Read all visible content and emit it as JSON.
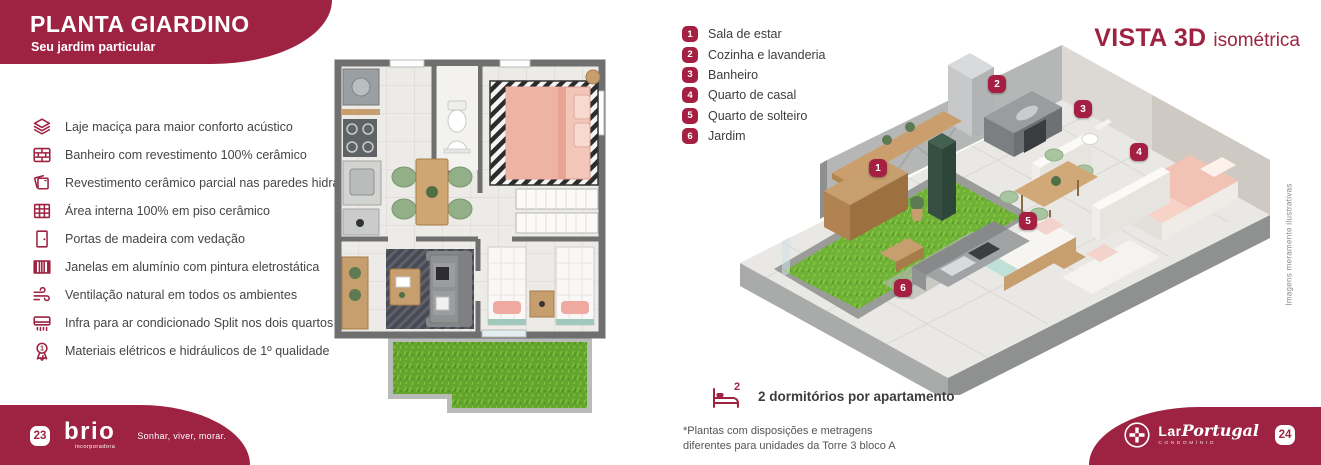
{
  "header": {
    "title": "PLANTA GIARDINO",
    "subtitle": "Seu jardim particular"
  },
  "features": [
    {
      "icon": "slab-layers-icon",
      "label": "Laje maciça para maior conforto acústico"
    },
    {
      "icon": "brick-wall-icon",
      "label": "Banheiro com revestimento 100% cerâmico"
    },
    {
      "icon": "ceramic-tiles-icon",
      "label": "Revestimento cerâmico parcial nas paredes hidráulicas"
    },
    {
      "icon": "floor-grid-icon",
      "label": "Área interna 100% em piso cerâmico"
    },
    {
      "icon": "door-icon",
      "label": "Portas de madeira com vedação"
    },
    {
      "icon": "window-icon",
      "label": "Janelas em alumínio com pintura eletrostática"
    },
    {
      "icon": "wind-icon",
      "label": "Ventilação natural em todos os ambientes"
    },
    {
      "icon": "air-conditioner-icon",
      "label": "Infra para ar condicionado Split nos dois quartos"
    },
    {
      "icon": "first-quality-medal-icon",
      "label": "Materiais elétricos e hidráulicos de 1º qualidade"
    }
  ],
  "legend": [
    {
      "number": "1",
      "label": "Sala de estar"
    },
    {
      "number": "2",
      "label": "Cozinha e lavanderia"
    },
    {
      "number": "3",
      "label": "Banheiro"
    },
    {
      "number": "4",
      "label": "Quarto de casal"
    },
    {
      "number": "5",
      "label": "Quarto de solteiro"
    },
    {
      "number": "6",
      "label": "Jardim"
    }
  ],
  "vista": {
    "title": "VISTA 3D",
    "subtitle": "isométrica"
  },
  "notes": {
    "vertical": "Imagens meramente ilustrativas",
    "dorm_count": "2",
    "dorm_label": "2 dormitórios por apartamento",
    "footnote_line1": "*Plantas com disposições e metragens",
    "footnote_line2": "diferentes para unidades da Torre 3 bloco A",
    "medal_number": "1"
  },
  "footer": {
    "left_page": "23",
    "brand": "brio",
    "brand_sub": "incorporadora",
    "tagline": "Sonhar, viver, morar.",
    "right_brand_lar": "Lar",
    "right_brand_portugal": "Portugal",
    "right_brand_sub": "CONDOMÍNIO",
    "right_page": "24"
  },
  "colors": {
    "accent": "#9e2342",
    "marker": "#a51f42",
    "grass": "#67aa31",
    "wood": "#c79e6e",
    "bed_pink": "#f3c3b6",
    "chair_green": "#a9c49f",
    "wall_gray": "#6f6f6f"
  }
}
